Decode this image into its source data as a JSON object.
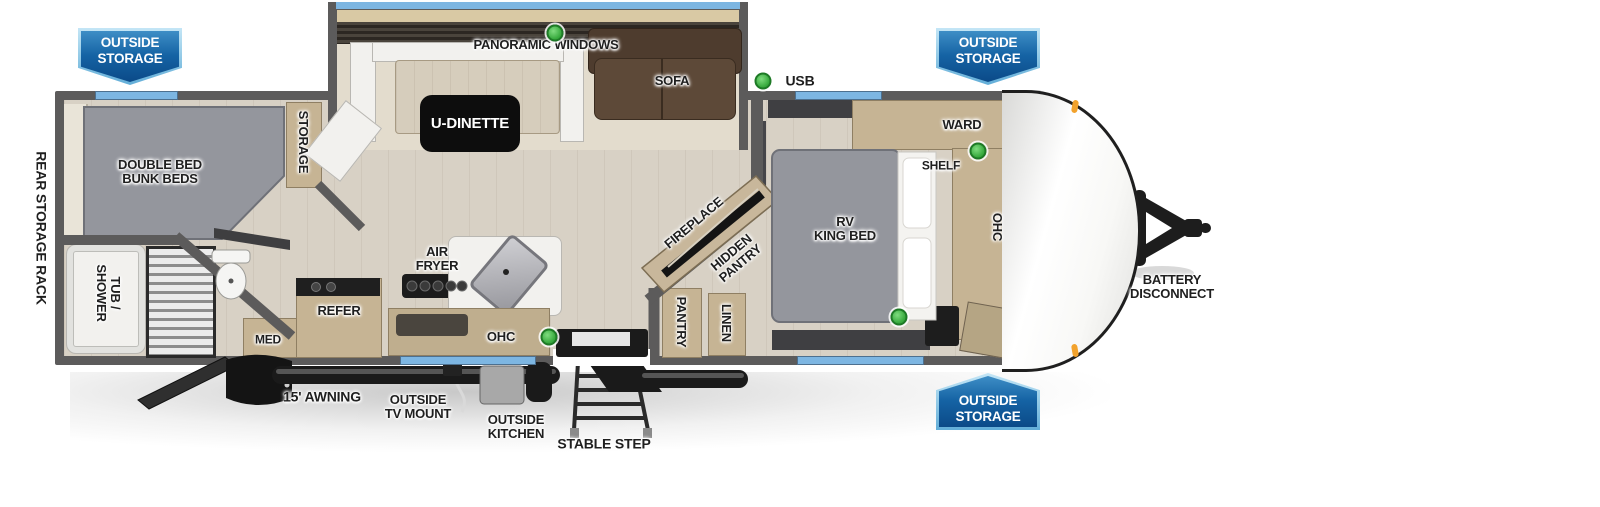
{
  "badges": {
    "rear": "OUTSIDE\nSTORAGE",
    "front_top": "OUTSIDE\nSTORAGE",
    "front_bottom": "OUTSIDE\nSTORAGE"
  },
  "labels": {
    "panoramic_windows": "PANORAMIC WINDOWS",
    "u_dinette": "U-DINETTE",
    "sofa": "SOFA",
    "usb": "USB",
    "storage": "STORAGE",
    "double_bed_bunk_beds": "DOUBLE BED\nBUNK BEDS",
    "rear_storage_rack": "REAR STORAGE RACK",
    "tub_shower": "TUB /\nSHOWER",
    "med": "MED",
    "refer": "REFER",
    "air_fryer": "AIR\nFRYER",
    "ohc_kitchen": "OHC",
    "fireplace": "FIREPLACE",
    "hidden_pantry": "HIDDEN\nPANTRY",
    "pantry": "PANTRY",
    "linen": "LINEN",
    "ward": "WARD",
    "shelf": "SHELF",
    "rv_king_bed": "RV\nKING BED",
    "ohc_bedroom": "OHC",
    "awning": "15' AWNING",
    "outside_tv_mount": "OUTSIDE\nTV MOUNT",
    "outside_kitchen": "OUTSIDE\nKITCHEN",
    "stable_step": "STABLE STEP",
    "battery_disconnect": "BATTERY\nDISCONNECT"
  },
  "colors": {
    "badge_blue": "#1563a4",
    "badge_border_blue": "#9fd4ef",
    "indicator_green": "#35a83b",
    "window_blue": "#7db6e2",
    "marker_orange": "#f2a22c",
    "wall_gray": "#5c5b5b",
    "floor_tan": "#d8d1c5",
    "bed_gray": "#94969d",
    "sofa_brown": "#5d4938",
    "cabinet_wood": "#c6b494"
  }
}
